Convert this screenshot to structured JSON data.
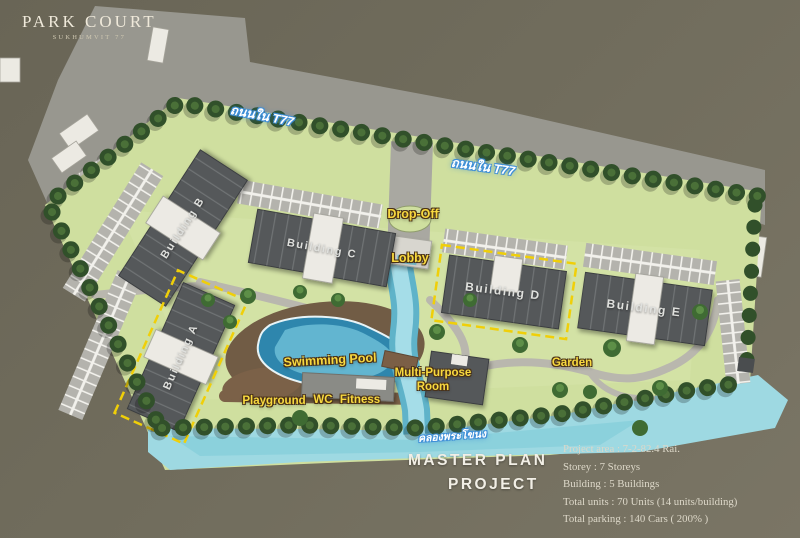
{
  "logo": {
    "title": "PARK COURT",
    "subtitle": "SUKHUMVIT 77"
  },
  "roads": {
    "t77_label_1": "ถนนใน T77",
    "t77_label_2": "ถนนใน T77",
    "canal_label": "คลองพระโขนง"
  },
  "buildings": {
    "a": "Building A",
    "b": "Building B",
    "c": "Building C",
    "d": "Building D",
    "e": "Building E"
  },
  "amenities": {
    "drop_off": "Drop-Off",
    "lobby": "Lobby",
    "swimming_pool": "Swimming Pool",
    "multi_purpose_line1": "Multi-Purpose",
    "multi_purpose_line2": "Room",
    "playground": "Playground",
    "wc": "WC",
    "fitness": "Fitness",
    "garden": "Garden"
  },
  "footer": {
    "title_line1": "MASTER PLAN",
    "title_line2": "PROJECT",
    "details": [
      "Project area :  7-2-82.4  Rai.",
      "Storey : 7 Storeys",
      "Building : 5 Buildings",
      "Total units : 70 Units (14 units/building)",
      "Total parking : 140 Cars ( 200% )"
    ]
  },
  "colors": {
    "background": "#706c5c",
    "road": "#98978f",
    "site_green": "#cfdf9f",
    "water": "#9ed9e2",
    "building": "#55585a",
    "label_yellow": "#f8d93f",
    "dashed_outline": "#f0cf08"
  }
}
